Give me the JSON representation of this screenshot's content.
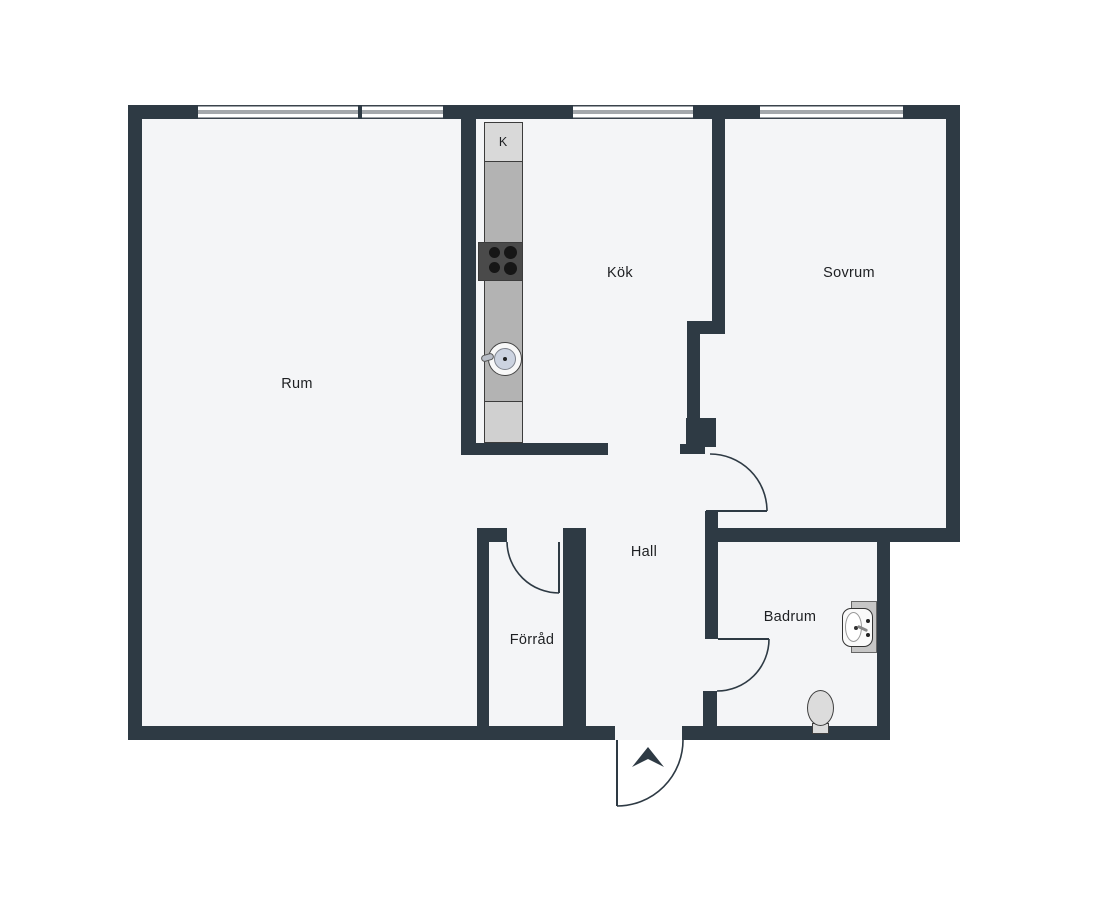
{
  "plan": {
    "rooms": {
      "rum": {
        "label": "Rum"
      },
      "kok": {
        "label": "Kök"
      },
      "sovrum": {
        "label": "Sovrum"
      },
      "hall": {
        "label": "Hall"
      },
      "forrad": {
        "label": "Förråd"
      },
      "badrum": {
        "label": "Badrum"
      }
    },
    "kitchen": {
      "fridge_label": "K"
    },
    "colors": {
      "wall": "#2e3a44",
      "floor": "#f4f5f7",
      "background": "#ffffff",
      "counter": "#b3b3b3",
      "counterLight": "#d0d0d0",
      "fridgeCell": "#d9d9d9",
      "stove": "#4a4a4a",
      "burner": "#161616",
      "fixture": "#dcdcdc",
      "sinkBasin": "#ccd3e0",
      "doorLine": "#2e3a44"
    }
  }
}
